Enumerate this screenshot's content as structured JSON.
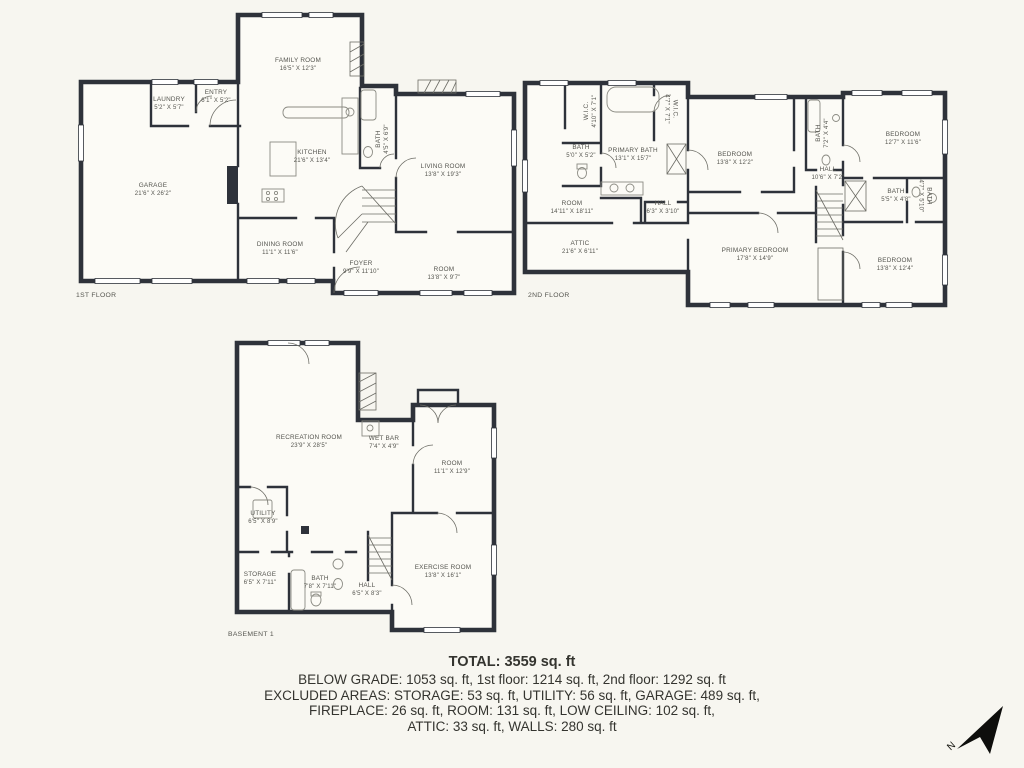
{
  "page": {
    "colors": {
      "background": "#f7f6f0",
      "walls": "#2e323a",
      "label_text": "#55554f",
      "summary_text": "#34342f"
    }
  },
  "floors": [
    {
      "caption": "1ST FLOOR",
      "rooms": [
        {
          "name": "FAMILY ROOM",
          "dims": "16'5\" X 12'3\""
        },
        {
          "name": "LAUNDRY",
          "dims": "5'2\" X 5'7\""
        },
        {
          "name": "ENTRY",
          "dims": "6'1\" X 5'2\""
        },
        {
          "name": "KITCHEN",
          "dims": "21'6\" X 13'4\""
        },
        {
          "name": "GARAGE",
          "dims": "21'6\" X 26'2\""
        },
        {
          "name": "LIVING ROOM",
          "dims": "13'8\" X 19'3\""
        },
        {
          "name": "BATH",
          "dims": "4'5\" X 6'9\""
        },
        {
          "name": "DINING ROOM",
          "dims": "11'1\" X 11'6\""
        },
        {
          "name": "FOYER",
          "dims": "9'9\" X 11'10\""
        },
        {
          "name": "ROOM",
          "dims": "13'8\" X 9'7\""
        }
      ]
    },
    {
      "caption": "2ND FLOOR",
      "rooms": [
        {
          "name": "W.I.C.",
          "dims": "4'10\" X 7'1\""
        },
        {
          "name": "PRIMARY BATH",
          "dims": "13'1\" X 15'7\""
        },
        {
          "name": "W.I.C.",
          "dims": "4'7\" X 7'1\""
        },
        {
          "name": "BATH",
          "dims": "5'0\" X 5'2\""
        },
        {
          "name": "BEDROOM",
          "dims": "13'8\" X 12'2\""
        },
        {
          "name": "ROOM",
          "dims": "14'11\" X 18'11\""
        },
        {
          "name": "HALL",
          "dims": "6'3\" X 3'10\""
        },
        {
          "name": "ATTIC",
          "dims": "21'6\" X 6'11\""
        },
        {
          "name": "BATH",
          "dims": "7'2\" X 4'4\""
        },
        {
          "name": "BEDROOM",
          "dims": "12'7\" X 11'6\""
        },
        {
          "name": "HALL",
          "dims": "10'6\" X 7'2\""
        },
        {
          "name": "BATH",
          "dims": "5'5\" X 4'8\""
        },
        {
          "name": "BATH",
          "dims": "4'7\" X 5'10\""
        },
        {
          "name": "PRIMARY BEDROOM",
          "dims": "17'8\" X 14'9\""
        },
        {
          "name": "BEDROOM",
          "dims": "13'8\" X 12'4\""
        }
      ]
    },
    {
      "caption": "BASEMENT 1",
      "rooms": [
        {
          "name": "RECREATION ROOM",
          "dims": "23'9\" X 28'5\""
        },
        {
          "name": "WET BAR",
          "dims": "7'4\" X 4'9\""
        },
        {
          "name": "ROOM",
          "dims": "11'1\" X 12'9\""
        },
        {
          "name": "UTILITY",
          "dims": "6'5\" X 8'9\""
        },
        {
          "name": "STORAGE",
          "dims": "6'5\" X 7'11\""
        },
        {
          "name": "BATH",
          "dims": "7'8\" X 7'11\""
        },
        {
          "name": "HALL",
          "dims": "6'5\" X 8'3\""
        },
        {
          "name": "EXERCISE ROOM",
          "dims": "13'8\" X 16'1\""
        }
      ]
    }
  ],
  "summary": {
    "total": "TOTAL: 3559 sq. ft",
    "line1": "BELOW GRADE: 1053 sq. ft, 1st floor: 1214 sq. ft, 2nd floor: 1292 sq. ft",
    "line2": "EXCLUDED AREAS: STORAGE: 53 sq. ft, UTILITY: 56 sq. ft, GARAGE: 489 sq. ft,",
    "line3": "FIREPLACE: 26 sq. ft, ROOM: 131 sq. ft, LOW CEILING: 102 sq. ft,",
    "line4": "ATTIC: 33 sq. ft, WALLS: 280 sq. ft"
  },
  "compass": {
    "label": "N"
  }
}
